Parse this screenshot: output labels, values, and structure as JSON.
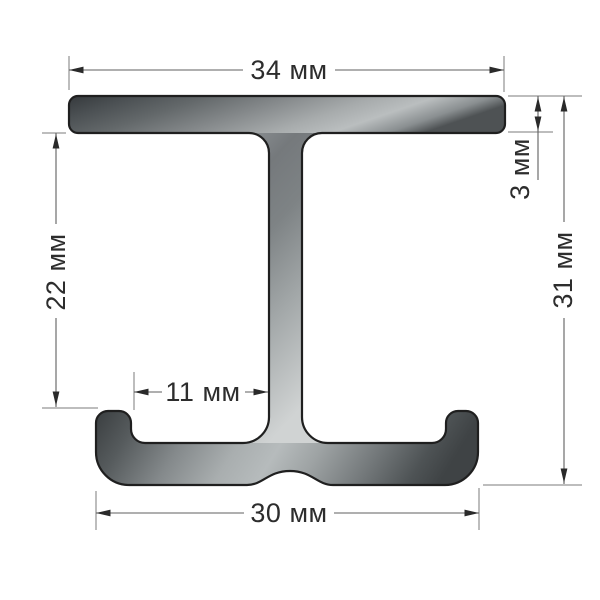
{
  "diagram": {
    "labels": {
      "top_width": "34 мм",
      "flange_thickness": "3 мм",
      "overall_height": "31 мм",
      "left_height": "22 мм",
      "inner_width": "11 мм",
      "bottom_width": "30 мм"
    },
    "unit": "мм",
    "colors": {
      "background": "#ffffff",
      "outline": "#1f1f1f",
      "dimension_line": "#5f5f5f",
      "extension_line": "#7b7b7b",
      "label_text": "#2d2d2d",
      "metal_dark": "#363a3d",
      "metal_mid": "#8f9496",
      "metal_light": "#d2d5d5"
    }
  }
}
